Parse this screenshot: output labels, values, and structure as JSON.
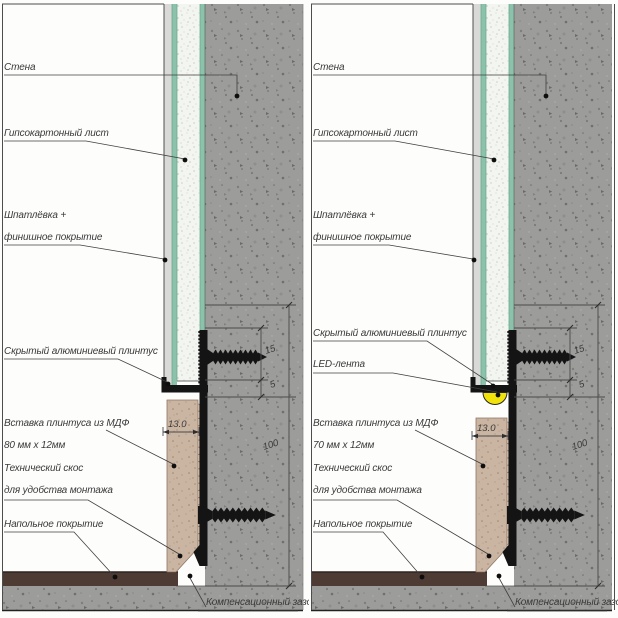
{
  "diagram": {
    "type": "construction-detail-section",
    "subject": "hidden aluminum plinth wall-floor junction, two variants (plain and with LED strip)"
  },
  "colors": {
    "concrete": "#9c9c9a",
    "drywall": "#f3f5f1",
    "green_facing": "#8cc2ab",
    "putty": "#d9d9d7",
    "mdf": "#cab4a2",
    "floor_covering": "#4e3b33",
    "aluminum": "#161616",
    "led": "#f2e20c",
    "line": "#4a4a4a"
  },
  "panels": {
    "left": {
      "labels": {
        "wall": "Стена",
        "drywall": "Гипсокартонный лист",
        "finish1": "Шпатлёвка +",
        "finish2": "финишное покрытие",
        "plinth": "Скрытый алюминиевый плинтус",
        "insert1": "Вставка плинтуса из МДФ",
        "insert2": "80 мм х 12мм",
        "bevel1": "Технический скос",
        "bevel2": "для удобства монтажа",
        "floor": "Напольное покрытие",
        "gap": "Компенсационный зазор"
      },
      "dims": {
        "plinth_height": "15",
        "shadow_gap": "5",
        "insert_thickness": "13.0",
        "total_height": "100"
      }
    },
    "right": {
      "labels": {
        "wall": "Стена",
        "drywall": "Гипсокартонный лист",
        "finish1": "Шпатлёвка +",
        "finish2": "финишное покрытие",
        "plinth": "Скрытый алюминиевый плинтус",
        "led": "LED-лента",
        "insert1": "Вставка плинтуса из МДФ",
        "insert2": "70 мм х 12мм",
        "bevel1": "Технический скос",
        "bevel2": "для удобства монтажа",
        "floor": "Напольное покрытие",
        "gap": "Компенсационный зазор"
      },
      "dims": {
        "plinth_height": "15",
        "shadow_gap": "5",
        "insert_thickness": "13.0",
        "total_height": "100"
      }
    }
  }
}
